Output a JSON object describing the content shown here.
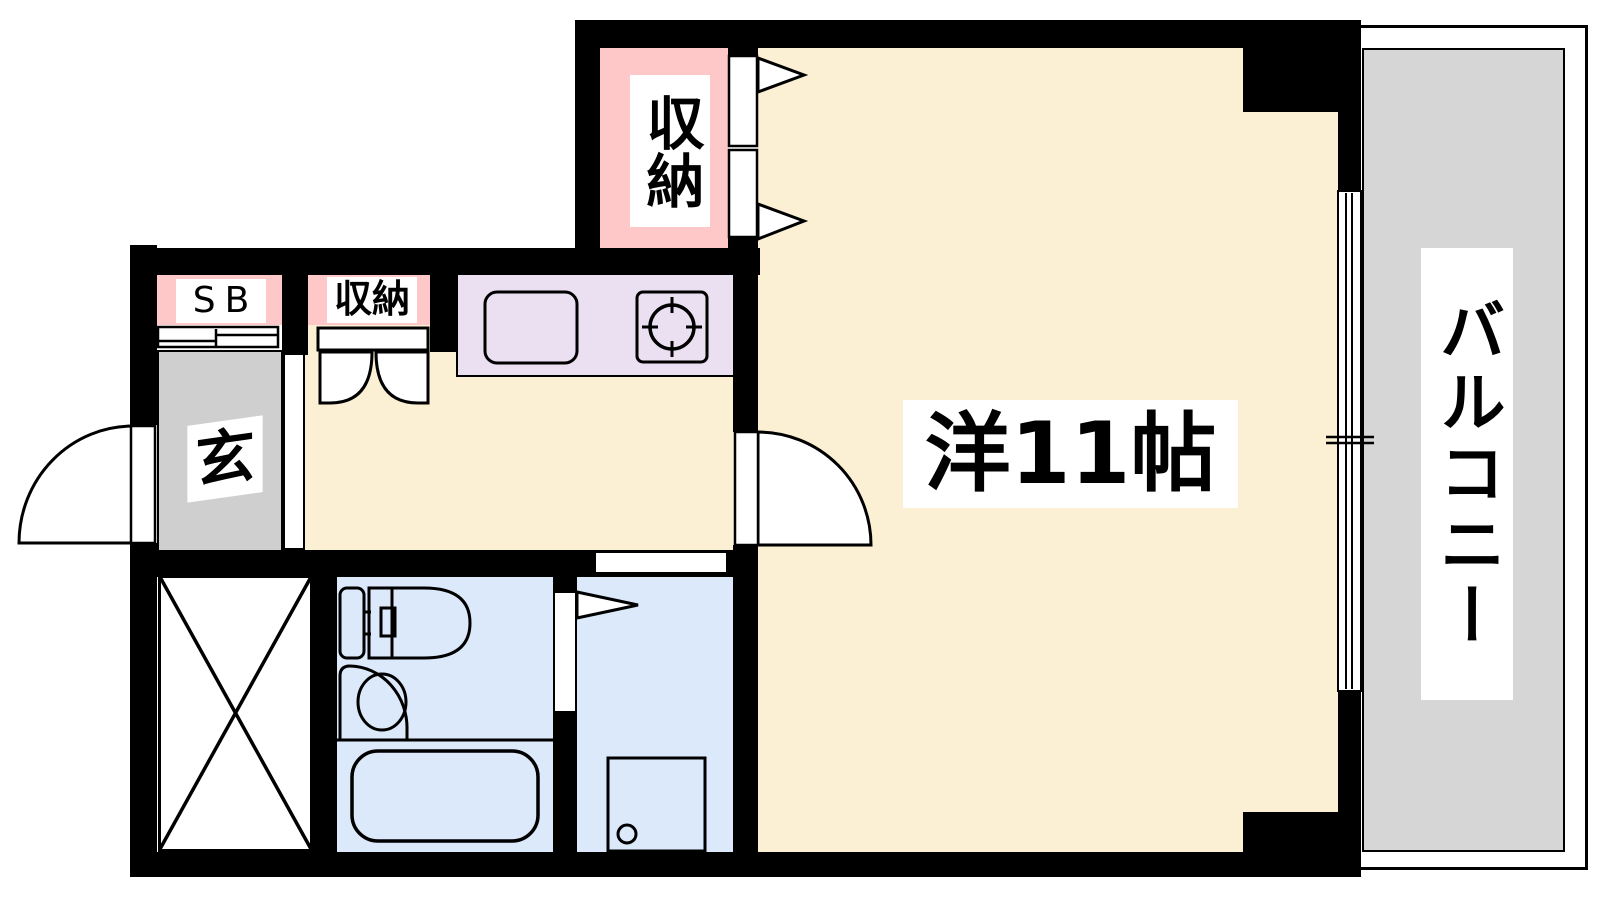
{
  "colors": {
    "wall": "#000000",
    "line": "#000000",
    "paper": "#FFFFFF",
    "cream": "#FBF0D4",
    "pink": "#FFC8C8",
    "lavender": "#EBDFF2",
    "blue": "#DBE9FA",
    "gray_entrance": "#CFCFCF",
    "gray_balcony": "#D6D6D6"
  },
  "labels": {
    "closet_top": "収納",
    "shoe_box": "SB",
    "closet_hall": "収納",
    "entrance": "玄",
    "main_room": "洋11帖",
    "balcony": "バルコニー"
  }
}
